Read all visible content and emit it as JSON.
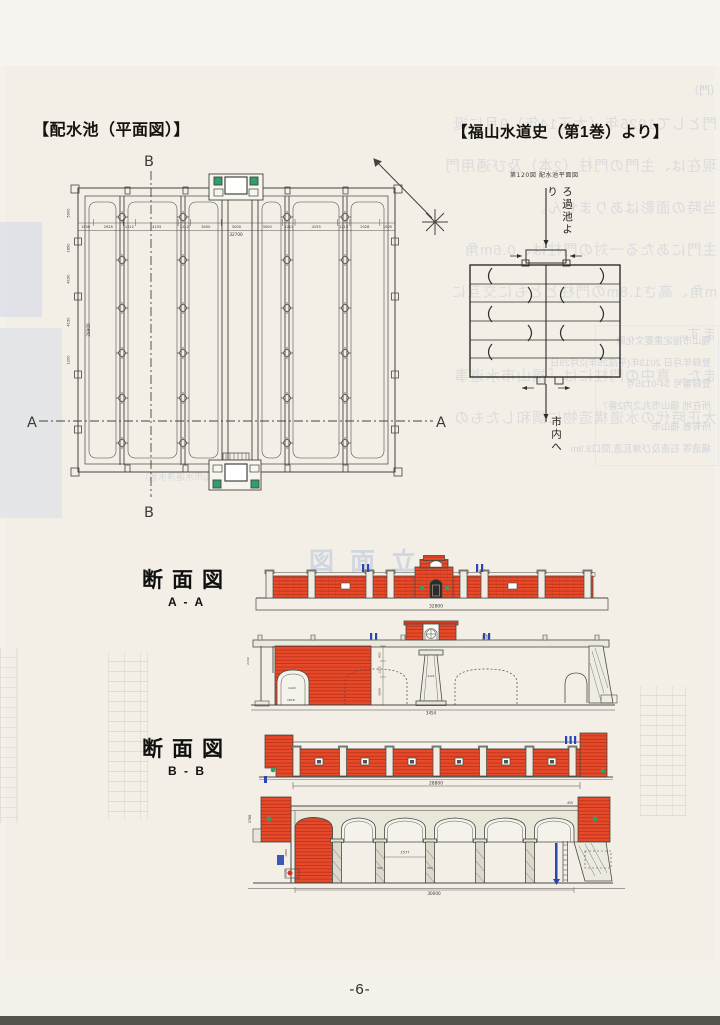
{
  "page": {
    "number": "-6-"
  },
  "headers": {
    "plan_title": "【配水池（平面図）】",
    "ref_title": "【福山水道史（第1巻）より】"
  },
  "plan": {
    "label_a": "A",
    "label_b": "B",
    "dims_top": [
      "1500",
      "2928",
      "1212",
      "4155",
      "1212",
      "3000",
      "3000",
      "3000",
      "1212",
      "4155",
      "1212",
      "2928",
      "1500"
    ],
    "dim_top_total": "32700",
    "dims_left": [
      "5000",
      "1850",
      "4150",
      "4150",
      "1200"
    ],
    "dim_left_total": "28800"
  },
  "ref_diagram": {
    "caption": "第120図 配水池平面図",
    "inlet": "ろ過池より",
    "outlet": "市内へ"
  },
  "section_a": {
    "title": "断面図",
    "sub": "A - A",
    "elev_total": "32800",
    "base_total": "3454",
    "wall_dim": "2132",
    "arch_dims": [
      "1424",
      "1818"
    ],
    "strip_dims": [
      "905",
      "1212",
      "3069"
    ],
    "column_dim": "2121"
  },
  "section_b": {
    "title": "断面図",
    "sub": "B - B",
    "elev_total": "28800",
    "sect_total": "30000",
    "bay_span": "2577",
    "bay_halves": [
      "562",
      "562"
    ],
    "height_left": "3788",
    "corner_dim": "455",
    "col_left_dims": [
      "1094",
      "2121"
    ]
  },
  "bleed": {
    "block1": [
      "門として1925年（大正14年）9月に誕",
      "現在は、主門の門柱（2本）及び通用門",
      "当時の面影はありません。",
      "主門にあたる一対の門柱は、0.6m角",
      "m角、高さ1.8mの門柱とともに交互に",
      "ます。",
      "また、真中の門柱には「福山市水道事",
      "大正時代の水道構造物に調和したもの"
    ],
    "box": [
      "福山市指定重要文化財",
      "登録年月日 2013年(平成25年)2月29日",
      "登録番号 34-0135号",
      "所在地 福山市丸之内2番7",
      "所有者 福山市",
      "構造等 石造及び煉瓦造,間口3.9m"
    ],
    "elev_label": "立面図",
    "pond_note": "（福山市水道浄水池）",
    "corner_note": "（門）"
  }
}
